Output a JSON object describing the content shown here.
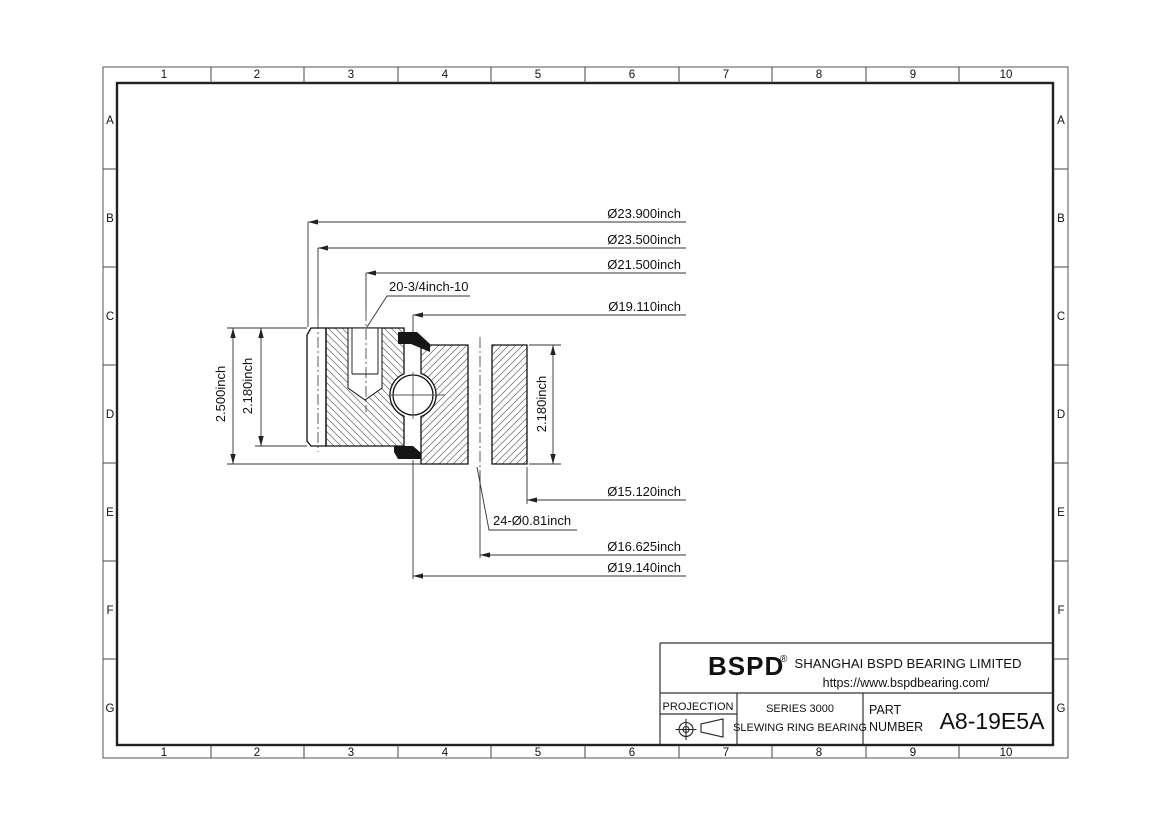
{
  "frame": {
    "columns": [
      "1",
      "2",
      "3",
      "4",
      "5",
      "6",
      "7",
      "8",
      "9",
      "10"
    ],
    "rows": [
      "A",
      "B",
      "C",
      "D",
      "E",
      "F",
      "G"
    ]
  },
  "dims": {
    "od": "Ø23.900inch",
    "pitch_od": "Ø23.500inch",
    "bolt_circle_outer": "Ø21.500inch",
    "race_upper": "Ø19.110inch",
    "bore": "Ø15.120inch",
    "bolt_circle_inner": "Ø16.625inch",
    "race_lower": "Ø19.140inch",
    "tapped_holes": "20-3/4inch-10",
    "through_holes": "24-Ø0.81inch",
    "overall_height": "2.500inch",
    "outer_ring_height": "2.180inch",
    "inner_ring_height": "2.180inch"
  },
  "title_block": {
    "logo": "BSPD",
    "registered": "®",
    "company": "SHANGHAI BSPD BEARING LIMITED",
    "website": "https://www.bspdbearing.com/",
    "projection_label": "PROJECTION",
    "series_line1": "SERIES 3000",
    "series_line2": "SLEWING RING BEARING",
    "part_label_line1": "PART",
    "part_label_line2": "NUMBER",
    "part_number": "A8-19E5A"
  },
  "colors": {
    "line": "#1a1a1a",
    "dim_line": "#333333",
    "hatch": "#6b6b6b",
    "seal_fill": "#161616"
  }
}
